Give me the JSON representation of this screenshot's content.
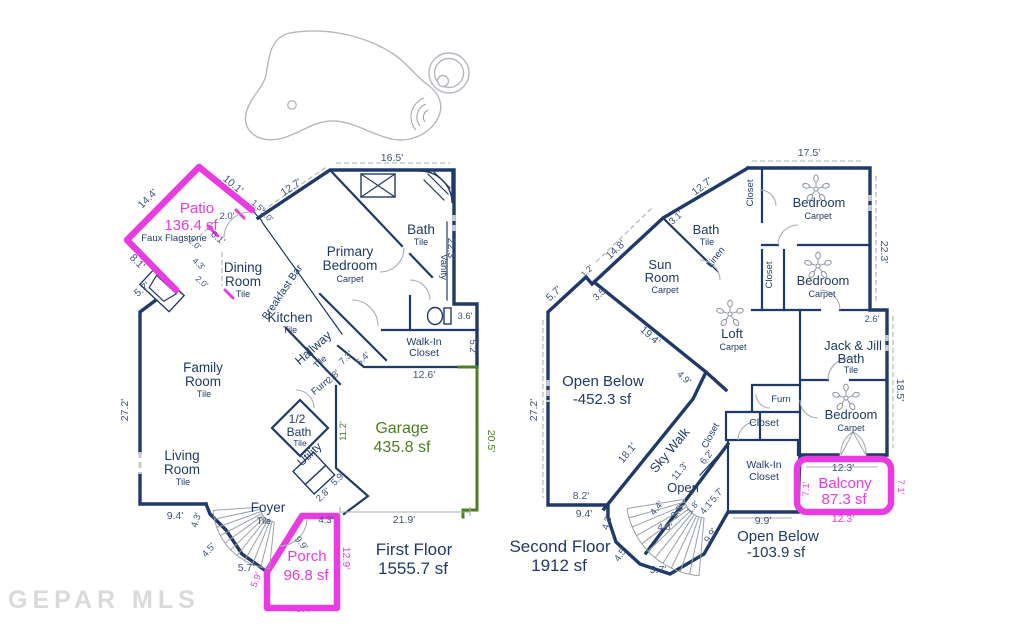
{
  "watermark": "GEPAR MLS",
  "colors": {
    "wall": "#1f3a68",
    "dim": "#3f527e",
    "accent": "#e93ce0",
    "garage": "#4c801f",
    "fixture_gray": "#9aa0a6",
    "watermark": "#d6d6d6"
  },
  "first_floor": {
    "labels": [
      {
        "t": "Patio",
        "x": 197,
        "y": 213,
        "s": 15,
        "c": "accent",
        "n": "room-label-patio"
      },
      {
        "t": "136.4 sf",
        "x": 191,
        "y": 230,
        "s": 15,
        "c": "accent",
        "n": "patio-area"
      },
      {
        "t": "Faux Flagstone",
        "x": 174,
        "y": 241,
        "s": 9.5,
        "c": "wall",
        "n": "patio-material"
      },
      {
        "t": "Dining",
        "x": 243,
        "y": 272,
        "s": 13.5,
        "c": "wall",
        "n": "room-label-dining"
      },
      {
        "t": "Room",
        "x": 243,
        "y": 286,
        "s": 13.5,
        "c": "wall",
        "n": "room-label-dining-2"
      },
      {
        "t": "Tile",
        "x": 243,
        "y": 297,
        "s": 9,
        "c": "wall",
        "n": "floor-material"
      },
      {
        "t": "Breakfast Bar",
        "x": 285,
        "y": 294,
        "s": 10.5,
        "c": "wall",
        "r": -56,
        "n": "label-breakfast-bar"
      },
      {
        "t": "Kitchen",
        "x": 290,
        "y": 322,
        "s": 13.5,
        "c": "wall",
        "n": "room-label-kitchen"
      },
      {
        "t": "Tile",
        "x": 290,
        "y": 333,
        "s": 9,
        "c": "wall",
        "n": "floor-material"
      },
      {
        "t": "Primary",
        "x": 350,
        "y": 256,
        "s": 13.5,
        "c": "wall",
        "n": "room-label-primary-bedroom"
      },
      {
        "t": "Bedroom",
        "x": 350,
        "y": 270,
        "s": 13.5,
        "c": "wall",
        "n": "room-label-primary-bedroom-2"
      },
      {
        "t": "Carpet",
        "x": 350,
        "y": 282,
        "s": 9,
        "c": "wall",
        "n": "floor-material"
      },
      {
        "t": "Bath",
        "x": 421,
        "y": 234,
        "s": 13.5,
        "c": "wall",
        "n": "room-label-bath"
      },
      {
        "t": "Tile",
        "x": 421,
        "y": 245,
        "s": 9,
        "c": "wall",
        "n": "floor-material"
      },
      {
        "t": "Vanity",
        "x": 441,
        "y": 267,
        "s": 9.5,
        "c": "wall",
        "r": 90,
        "n": "label-vanity"
      },
      {
        "t": "Hallway",
        "x": 316,
        "y": 351,
        "s": 12.5,
        "c": "wall",
        "r": -42,
        "n": "room-label-hallway"
      },
      {
        "t": "Tile",
        "x": 322,
        "y": 364,
        "s": 9,
        "c": "wall",
        "r": -42,
        "n": "floor-material"
      },
      {
        "t": "Walk-In",
        "x": 424,
        "y": 345,
        "s": 10.5,
        "c": "wall",
        "n": "room-label-walkin-closet"
      },
      {
        "t": "Closet",
        "x": 424,
        "y": 356,
        "s": 10.5,
        "c": "wall",
        "n": "room-label-walkin-closet-2"
      },
      {
        "t": "Family",
        "x": 203,
        "y": 372,
        "s": 13.5,
        "c": "wall",
        "n": "room-label-family-room"
      },
      {
        "t": "Room",
        "x": 203,
        "y": 386,
        "s": 13.5,
        "c": "wall",
        "n": "room-label-family-room-2"
      },
      {
        "t": "Tile",
        "x": 204,
        "y": 397,
        "s": 9,
        "c": "wall",
        "n": "floor-material"
      },
      {
        "t": "Living",
        "x": 182,
        "y": 460,
        "s": 13.5,
        "c": "wall",
        "n": "room-label-living-room"
      },
      {
        "t": "Room",
        "x": 182,
        "y": 474,
        "s": 13.5,
        "c": "wall",
        "n": "room-label-living-room-2"
      },
      {
        "t": "Tile",
        "x": 183,
        "y": 485,
        "s": 9,
        "c": "wall",
        "n": "floor-material"
      },
      {
        "t": "1/2",
        "x": 297,
        "y": 423,
        "s": 12,
        "c": "wall",
        "n": "room-label-half-bath"
      },
      {
        "t": "Bath",
        "x": 299,
        "y": 436,
        "s": 12,
        "c": "wall",
        "n": "room-label-half-bath-2"
      },
      {
        "t": "Tile",
        "x": 300,
        "y": 446,
        "s": 8.5,
        "c": "wall",
        "n": "floor-material"
      },
      {
        "t": "Utility",
        "x": 312,
        "y": 457,
        "s": 11.5,
        "c": "wall",
        "r": -43,
        "n": "room-label-utility"
      },
      {
        "t": "Furn",
        "x": 322,
        "y": 389,
        "s": 9.5,
        "c": "wall",
        "r": -40,
        "n": "label-furnace"
      },
      {
        "t": "Foyer",
        "x": 268,
        "y": 512,
        "s": 13.5,
        "c": "wall",
        "n": "room-label-foyer"
      },
      {
        "t": "Tile",
        "x": 264,
        "y": 524,
        "s": 9,
        "c": "wall",
        "n": "floor-material"
      },
      {
        "t": "Porch",
        "x": 307,
        "y": 561,
        "s": 15,
        "c": "accent",
        "n": "room-label-porch"
      },
      {
        "t": "96.8 sf",
        "x": 306,
        "y": 580,
        "s": 15,
        "c": "accent",
        "n": "porch-area"
      },
      {
        "t": "Garage",
        "x": 402,
        "y": 433,
        "s": 16,
        "c": "garage",
        "n": "room-label-garage"
      },
      {
        "t": "435.8 sf",
        "x": 402,
        "y": 452,
        "s": 16,
        "c": "garage",
        "n": "garage-area"
      },
      {
        "t": "First Floor",
        "x": 414,
        "y": 555,
        "s": 17,
        "c": "wall",
        "n": "first-floor-title"
      },
      {
        "t": "1555.7 sf",
        "x": 413,
        "y": 574,
        "s": 17,
        "c": "wall",
        "n": "first-floor-area"
      },
      {
        "t": "16.5'",
        "x": 392,
        "y": 161
      },
      {
        "t": "12.7'",
        "x": 293,
        "y": 190,
        "r": -34
      },
      {
        "t": "10.1'",
        "x": 231,
        "y": 187,
        "r": 40
      },
      {
        "t": "1.5'",
        "x": 256,
        "y": 208,
        "r": 40,
        "s": 8.5
      },
      {
        "t": "3.0'",
        "x": 265,
        "y": 218,
        "r": 40,
        "s": 8.5
      },
      {
        "t": "2.0'",
        "x": 227,
        "y": 219,
        "s": 9.5
      },
      {
        "t": "6.1'",
        "x": 216,
        "y": 240,
        "r": 40,
        "s": 9.5
      },
      {
        "t": "2.0'",
        "x": 193,
        "y": 246,
        "r": 40,
        "s": 8.5
      },
      {
        "t": "4.3'",
        "x": 197,
        "y": 266,
        "r": 40,
        "s": 8.5
      },
      {
        "t": "2.0'",
        "x": 200,
        "y": 284,
        "r": 40,
        "s": 8.5
      },
      {
        "t": "14.4'",
        "x": 150,
        "y": 201,
        "r": -45
      },
      {
        "t": "8.1'",
        "x": 135,
        "y": 264,
        "r": 45
      },
      {
        "t": "5.7'",
        "x": 144,
        "y": 292,
        "r": -38
      },
      {
        "t": "22.3'",
        "x": 448,
        "y": 249,
        "r": 90
      },
      {
        "t": "3.6'",
        "x": 465,
        "y": 319,
        "s": 9.5
      },
      {
        "t": "5.2'",
        "x": 470,
        "y": 347,
        "r": 90,
        "s": 9.5
      },
      {
        "t": "12.6'",
        "x": 424,
        "y": 378
      },
      {
        "t": "7.3'",
        "x": 348,
        "y": 360,
        "r": -44,
        "s": 9.5
      },
      {
        "t": "5.4'",
        "x": 365,
        "y": 361,
        "r": -44,
        "s": 9.5
      },
      {
        "t": "2.8'",
        "x": 335,
        "y": 379,
        "r": -44,
        "s": 9.5
      },
      {
        "t": "27.2'",
        "x": 128,
        "y": 410,
        "r": -90
      },
      {
        "t": "11.2'",
        "x": 346,
        "y": 431,
        "r": -90,
        "s": 9.5,
        "c": "garage"
      },
      {
        "t": "5.9'",
        "x": 340,
        "y": 481,
        "r": -44,
        "s": 9.5
      },
      {
        "t": "2.8'",
        "x": 325,
        "y": 497,
        "r": -44,
        "s": 9.5
      },
      {
        "t": "9.4'",
        "x": 175,
        "y": 519
      },
      {
        "t": "4.3'",
        "x": 199,
        "y": 521,
        "r": -72,
        "s": 9.5
      },
      {
        "t": "4.5'",
        "x": 211,
        "y": 552,
        "r": -50,
        "s": 9.5
      },
      {
        "t": "5.7'",
        "x": 246,
        "y": 571
      },
      {
        "t": "21.9'",
        "x": 404,
        "y": 523
      },
      {
        "t": "20.5'",
        "x": 488,
        "y": 441,
        "r": 90,
        "c": "garage"
      },
      {
        "t": "4.3'",
        "x": 326,
        "y": 523,
        "s": 9.5
      },
      {
        "t": "9.9'",
        "x": 299,
        "y": 545,
        "r": 52,
        "s": 9.5
      },
      {
        "t": "12.9'",
        "x": 343,
        "y": 558,
        "r": 90,
        "c": "accent"
      },
      {
        "t": "5.9'",
        "x": 259,
        "y": 581,
        "r": -68,
        "c": "accent",
        "s": 9.5
      },
      {
        "t": "9.4'",
        "x": 304,
        "y": 612,
        "c": "accent"
      }
    ]
  },
  "second_floor": {
    "labels": [
      {
        "t": "Sun",
        "x": 660,
        "y": 269,
        "s": 13,
        "c": "wall",
        "n": "room-label-sun-room"
      },
      {
        "t": "Room",
        "x": 662,
        "y": 282,
        "s": 13,
        "c": "wall",
        "n": "room-label-sun-room-2"
      },
      {
        "t": "Carpet",
        "x": 665,
        "y": 293,
        "s": 9,
        "c": "wall",
        "n": "floor-material"
      },
      {
        "t": "Bath",
        "x": 706,
        "y": 234,
        "s": 13,
        "c": "wall",
        "n": "room-label-upstairs-bath"
      },
      {
        "t": "Tile",
        "x": 707,
        "y": 245,
        "s": 9,
        "c": "wall",
        "n": "floor-material"
      },
      {
        "t": "Linen",
        "x": 718,
        "y": 259,
        "s": 9.5,
        "c": "wall",
        "r": -52,
        "n": "label-linen"
      },
      {
        "t": "Closet",
        "x": 753,
        "y": 193,
        "s": 9.5,
        "c": "wall",
        "r": -90,
        "n": "label-closet"
      },
      {
        "t": "Bedroom",
        "x": 819,
        "y": 207,
        "s": 13,
        "c": "wall",
        "n": "room-label-bedroom-1"
      },
      {
        "t": "Carpet",
        "x": 818,
        "y": 219,
        "s": 9,
        "c": "wall",
        "n": "floor-material"
      },
      {
        "t": "Bedroom",
        "x": 823,
        "y": 285,
        "s": 13,
        "c": "wall",
        "n": "room-label-bedroom-2"
      },
      {
        "t": "Carpet",
        "x": 822,
        "y": 297,
        "s": 9,
        "c": "wall",
        "n": "floor-material"
      },
      {
        "t": "Closet",
        "x": 772,
        "y": 275,
        "s": 9.5,
        "c": "wall",
        "r": -90,
        "n": "label-closet"
      },
      {
        "t": "Loft",
        "x": 732,
        "y": 338,
        "s": 13,
        "c": "wall",
        "n": "room-label-loft"
      },
      {
        "t": "Carpet",
        "x": 733,
        "y": 350,
        "s": 9,
        "c": "wall",
        "n": "floor-material"
      },
      {
        "t": "Jack & Jill",
        "x": 853,
        "y": 350,
        "s": 13,
        "c": "wall",
        "n": "room-label-jack-and-jill-bath"
      },
      {
        "t": "Bath",
        "x": 851,
        "y": 363,
        "s": 13,
        "c": "wall",
        "n": "room-label-jack-and-jill-bath-2"
      },
      {
        "t": "Tile",
        "x": 851,
        "y": 373,
        "s": 9,
        "c": "wall",
        "n": "floor-material"
      },
      {
        "t": "Bedroom",
        "x": 851,
        "y": 419,
        "s": 13,
        "c": "wall",
        "n": "room-label-bedroom-3"
      },
      {
        "t": "Carpet",
        "x": 851,
        "y": 431,
        "s": 9,
        "c": "wall",
        "n": "floor-material"
      },
      {
        "t": "Furn",
        "x": 781,
        "y": 402,
        "s": 9.5,
        "c": "wall",
        "n": "label-furnace"
      },
      {
        "t": "Closet",
        "x": 764,
        "y": 426,
        "s": 10.5,
        "c": "wall",
        "n": "label-closet"
      },
      {
        "t": "Closet",
        "x": 713,
        "y": 437,
        "s": 9.5,
        "c": "wall",
        "r": -62,
        "n": "label-closet"
      },
      {
        "t": "Sky Walk",
        "x": 673,
        "y": 453,
        "s": 13,
        "c": "wall",
        "r": -50,
        "n": "room-label-sky-walk"
      },
      {
        "t": "Open",
        "x": 683,
        "y": 492,
        "s": 13,
        "c": "wall",
        "n": "label-open"
      },
      {
        "t": "Walk-In",
        "x": 764,
        "y": 468,
        "s": 10.5,
        "c": "wall",
        "n": "room-label-walkin-closet"
      },
      {
        "t": "Closet",
        "x": 764,
        "y": 480,
        "s": 10.5,
        "c": "wall",
        "n": "room-label-walkin-closet-2"
      },
      {
        "t": "Balcony",
        "x": 845,
        "y": 488,
        "s": 15,
        "c": "accent",
        "n": "room-label-balcony"
      },
      {
        "t": "87.3 sf",
        "x": 844,
        "y": 504,
        "s": 15,
        "c": "accent",
        "n": "balcony-area"
      },
      {
        "t": "Open Below",
        "x": 603,
        "y": 386,
        "s": 15,
        "c": "wall",
        "n": "label-open-below-1"
      },
      {
        "t": "-452.3 sf",
        "x": 602,
        "y": 404,
        "s": 15,
        "c": "wall",
        "n": "open-below-area-1"
      },
      {
        "t": "Open Below",
        "x": 778,
        "y": 541,
        "s": 15,
        "c": "wall",
        "n": "label-open-below-2"
      },
      {
        "t": "-103.9 sf",
        "x": 776,
        "y": 557,
        "s": 15,
        "c": "wall",
        "n": "open-below-area-2"
      },
      {
        "t": "Second Floor",
        "x": 560,
        "y": 552,
        "s": 17,
        "c": "wall",
        "n": "second-floor-title"
      },
      {
        "t": "1912 sf",
        "x": 559,
        "y": 571,
        "s": 17,
        "c": "wall",
        "n": "second-floor-area"
      },
      {
        "t": "17.5'",
        "x": 809,
        "y": 156
      },
      {
        "t": "12.7'",
        "x": 704,
        "y": 189,
        "r": -37
      },
      {
        "t": "3.1'",
        "x": 678,
        "y": 220,
        "r": -42,
        "s": 9.5
      },
      {
        "t": "14.8'",
        "x": 618,
        "y": 252,
        "r": -43
      },
      {
        "t": "5.7'",
        "x": 556,
        "y": 296,
        "r": -43
      },
      {
        "t": "1.2'",
        "x": 589,
        "y": 273,
        "r": -43,
        "s": 8.5
      },
      {
        "t": "3.5'",
        "x": 602,
        "y": 296,
        "r": -43,
        "s": 9.5
      },
      {
        "t": "19.4'",
        "x": 648,
        "y": 338,
        "r": 42
      },
      {
        "t": "4.9'",
        "x": 682,
        "y": 380,
        "r": 42,
        "s": 9.5
      },
      {
        "t": "27.2'",
        "x": 537,
        "y": 410,
        "r": -90
      },
      {
        "t": "22.3'",
        "x": 881,
        "y": 252,
        "r": 90
      },
      {
        "t": "2.6'",
        "x": 872,
        "y": 322,
        "s": 9.5
      },
      {
        "t": "18.5'",
        "x": 897,
        "y": 390,
        "r": 90
      },
      {
        "t": "18.1'",
        "x": 630,
        "y": 455,
        "r": -51
      },
      {
        "t": "6.2'",
        "x": 709,
        "y": 459,
        "r": -51,
        "s": 9.5
      },
      {
        "t": "11.3'",
        "x": 682,
        "y": 473,
        "r": -51,
        "s": 9.5
      },
      {
        "t": "4.4'",
        "x": 659,
        "y": 510,
        "r": -51,
        "s": 9.5
      },
      {
        "t": "2.8'",
        "x": 680,
        "y": 513,
        "r": -51,
        "s": 9.5
      },
      {
        "t": "1.8'",
        "x": 695,
        "y": 509,
        "r": -51,
        "s": 8.5
      },
      {
        "t": "4.1'",
        "x": 709,
        "y": 509,
        "r": -51,
        "s": 9.5
      },
      {
        "t": "5.7'",
        "x": 719,
        "y": 497,
        "r": -51,
        "s": 9.5
      },
      {
        "t": "4.8'",
        "x": 665,
        "y": 530,
        "s": 9.5
      },
      {
        "t": "9.9'",
        "x": 713,
        "y": 537,
        "r": -57,
        "s": 9.5
      },
      {
        "t": "9.9'",
        "x": 763,
        "y": 524
      },
      {
        "t": "8.2'",
        "x": 581,
        "y": 499
      },
      {
        "t": "9.4'",
        "x": 584,
        "y": 517
      },
      {
        "t": "4.3'",
        "x": 610,
        "y": 523,
        "r": -74,
        "s": 9.5
      },
      {
        "t": "4.5'",
        "x": 623,
        "y": 556,
        "r": -55,
        "s": 9.5
      },
      {
        "t": "5.7'",
        "x": 658,
        "y": 573
      },
      {
        "t": "12.3'",
        "x": 843,
        "y": 471
      },
      {
        "t": "12.3'",
        "x": 843,
        "y": 522,
        "c": "accent"
      },
      {
        "t": "7.1'",
        "x": 809,
        "y": 489,
        "r": -90,
        "c": "accent",
        "s": 9.5
      },
      {
        "t": "7.1'",
        "x": 898,
        "y": 487,
        "r": 90,
        "c": "accent",
        "s": 9.5
      }
    ]
  }
}
